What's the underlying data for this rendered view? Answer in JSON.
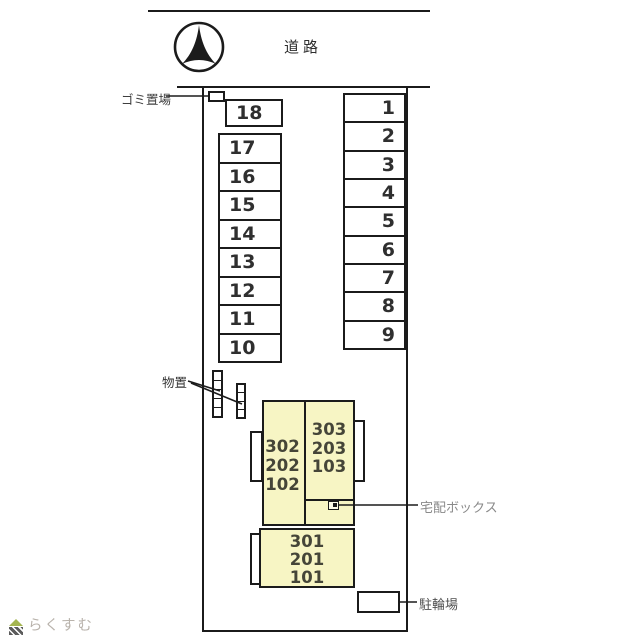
{
  "plan": {
    "road_label": "道路",
    "garbage_area_label": "ゴミ置場",
    "storage_label": "物置",
    "delivery_box_label": "宅配ボックス",
    "bicycle_parking_label": "駐輪場",
    "parking_left": [
      "18",
      "17",
      "16",
      "15",
      "14",
      "13",
      "12",
      "11",
      "10"
    ],
    "parking_right": [
      "1",
      "2",
      "3",
      "4",
      "5",
      "6",
      "7",
      "8",
      "9"
    ],
    "building": {
      "unit_west": [
        "302",
        "202",
        "102"
      ],
      "unit_east": [
        "303",
        "203",
        "103"
      ],
      "unit_south": [
        "301",
        "201",
        "101"
      ]
    },
    "watermark": {
      "text": "らくすむ"
    },
    "colors": {
      "building_fill": "#f7f5c4",
      "line": "#1b1b1b",
      "label_gray": "#8a8a8a",
      "watermark_text": "#b9b3ac",
      "watermark_green": "#a4b54f",
      "watermark_dark": "#5c5c5c"
    }
  }
}
